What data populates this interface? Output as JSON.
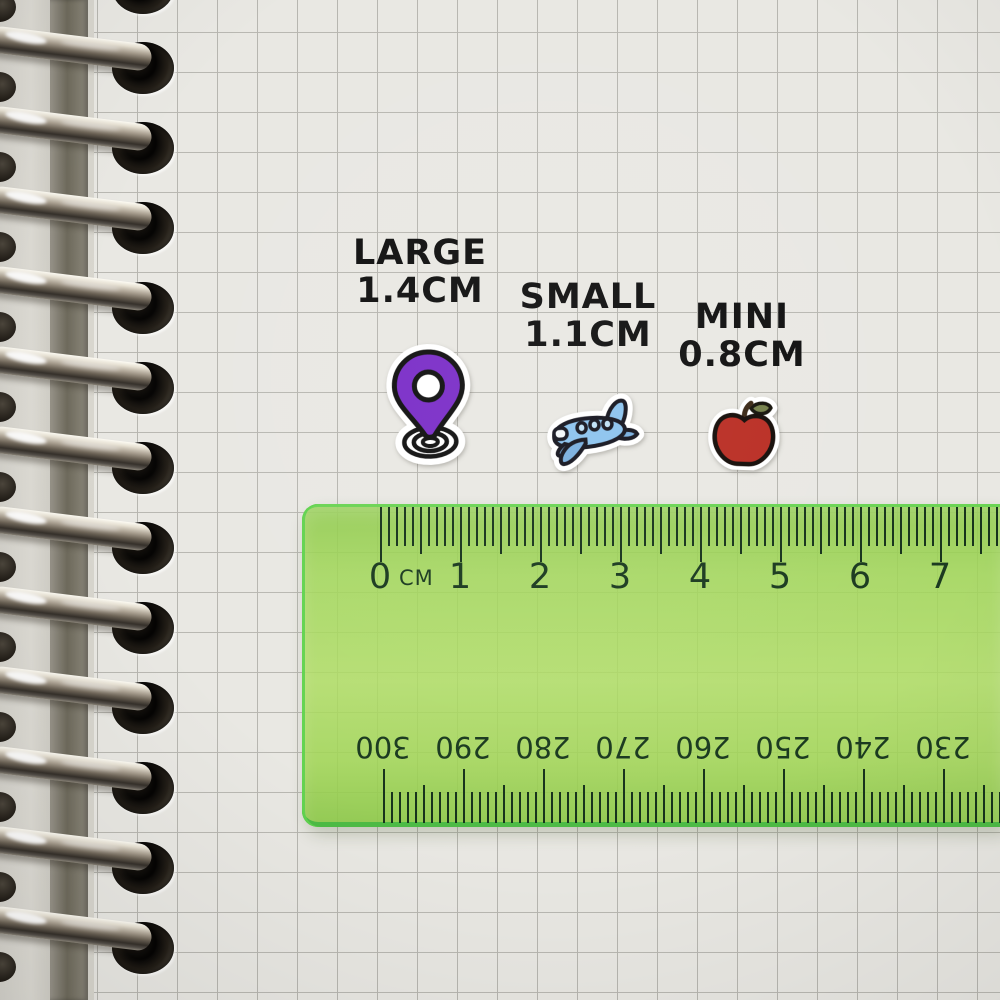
{
  "labels": [
    {
      "name": "large",
      "line1": "LARGE",
      "line2": "1.4CM"
    },
    {
      "name": "small",
      "line1": "SMALL",
      "line2": "1.1CM"
    },
    {
      "name": "mini",
      "line1": "MINI",
      "line2": "0.8CM"
    }
  ],
  "stickers": [
    {
      "name": "location-pin",
      "color": "#7B2EC8"
    },
    {
      "name": "airplane",
      "color": "#8CC3EE"
    },
    {
      "name": "apple",
      "color": "#BA2E24"
    }
  ],
  "ruler": {
    "unit_label": "CM",
    "top_scale_numbers": [
      "0",
      "1",
      "2",
      "3",
      "4",
      "5",
      "6",
      "7"
    ],
    "bottom_scale_numbers": [
      "300",
      "290",
      "280",
      "270",
      "260",
      "250",
      "240",
      "230"
    ],
    "colors": {
      "body": "#a0d656",
      "edge": "#60d34f",
      "ink": "#17331c"
    }
  },
  "notebook": {
    "ring_count": 13,
    "colors": {
      "paper": "#e9e8e3",
      "grid_line": "#b8b7b1",
      "ring_metal": "#a79d8e"
    }
  }
}
